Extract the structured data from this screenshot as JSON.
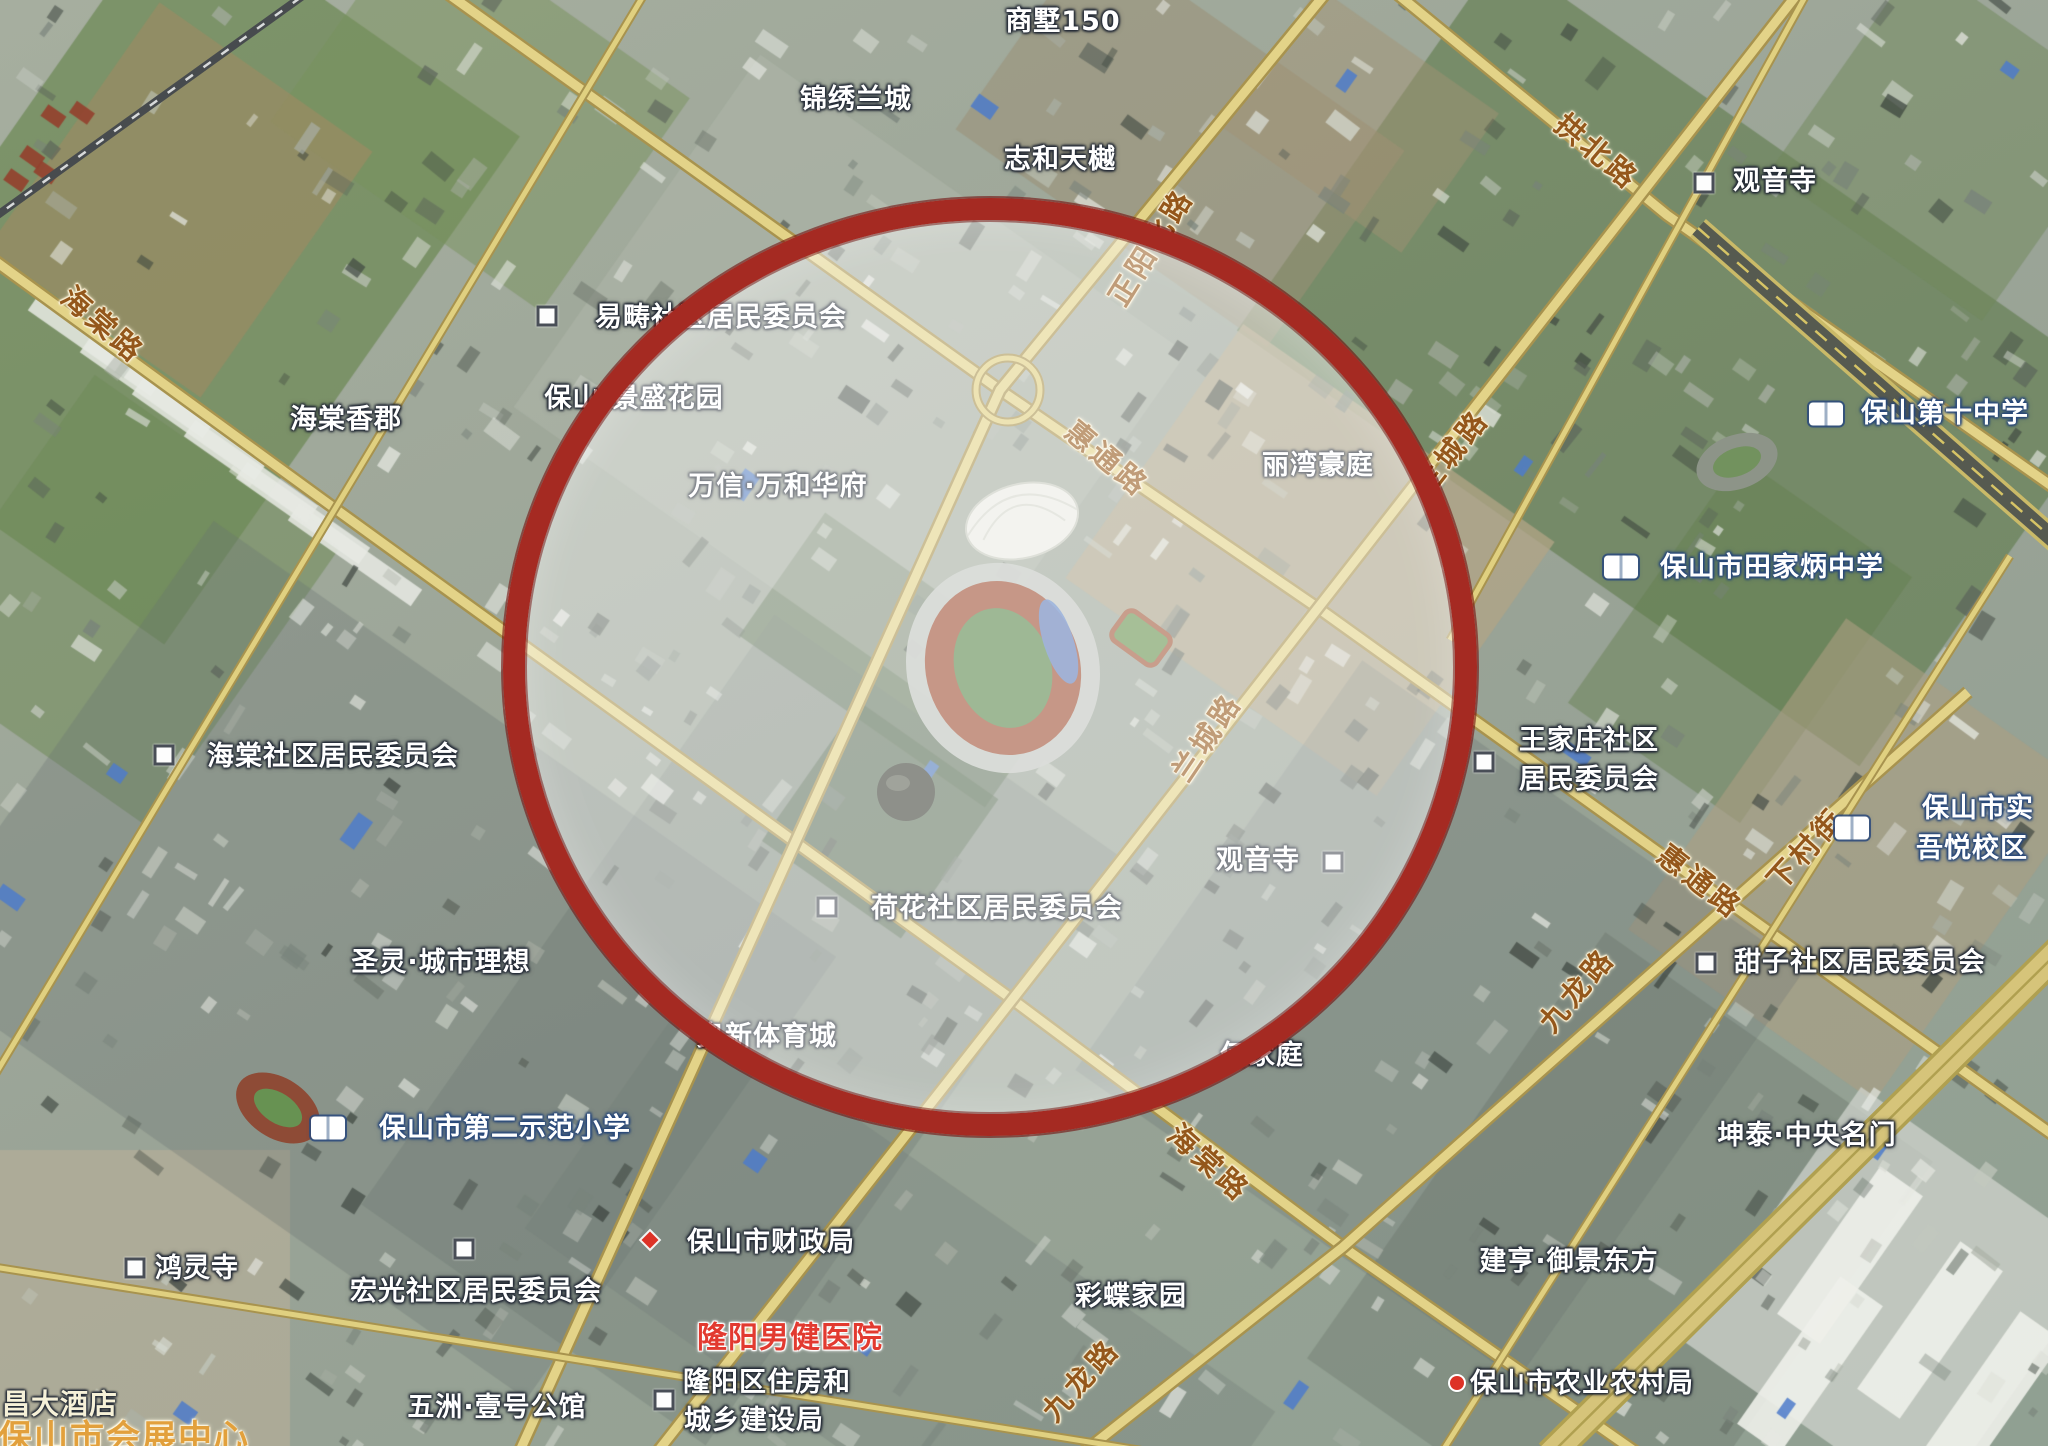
{
  "app": {
    "title": "satellite-map-view",
    "city_hint": "保山"
  },
  "colors": {
    "poi_label": "#ffffff",
    "road_label": "#94571b",
    "road_label_outline": "#f8efd4",
    "school_outline": "#2c4a7c",
    "hospital_red": "#e23a30",
    "landmark_gold": "#e2a03c",
    "road_fill": "#e3d388",
    "road_casing": "#a8934e",
    "highlight_ring": "#a52a22"
  },
  "highlight": {
    "cx": 990,
    "cy": 667,
    "rx": 465,
    "ry": 447,
    "border": 22,
    "fill_alpha": 0.41
  },
  "labels": [
    {
      "id": "shangshu150",
      "text": "商墅150",
      "x": 1063,
      "y": 22,
      "t": "poi"
    },
    {
      "id": "jinxiulancheng",
      "text": "锦绣兰城",
      "x": 856,
      "y": 100,
      "t": "poi"
    },
    {
      "id": "zhihetianyue",
      "text": "志和天樾",
      "x": 1060,
      "y": 160,
      "t": "poi"
    },
    {
      "id": "zhengyangbeilu",
      "text": "正阳北路",
      "x": 1151,
      "y": 247,
      "t": "road",
      "rot": -58
    },
    {
      "id": "gongbeilu",
      "text": "拱北路",
      "x": 1597,
      "y": 152,
      "t": "road",
      "rot": 40
    },
    {
      "id": "guanyinsi-n",
      "text": "观音寺",
      "x": 1775,
      "y": 182,
      "t": "poi"
    },
    {
      "id": "haitanglu-nw",
      "text": "海棠路",
      "x": 103,
      "y": 325,
      "t": "road",
      "rot": 41
    },
    {
      "id": "yichou",
      "text": "易畴社区居民委员会",
      "x": 721,
      "y": 318,
      "t": "poi"
    },
    {
      "id": "jingshenghuayuan",
      "text": "保山·景盛花园",
      "x": 634,
      "y": 399,
      "t": "poi"
    },
    {
      "id": "haitangxiangjun",
      "text": "海棠香郡",
      "x": 346,
      "y": 420,
      "t": "poi"
    },
    {
      "id": "wanxinwanhehuafu",
      "text": "万信·万和华府",
      "x": 778,
      "y": 487,
      "t": "poi"
    },
    {
      "id": "huitonglu-c",
      "text": "惠通路",
      "x": 1107,
      "y": 459,
      "t": "road",
      "rot": 40
    },
    {
      "id": "liwanhaoting",
      "text": "丽湾豪庭",
      "x": 1318,
      "y": 466,
      "t": "poi"
    },
    {
      "id": "lanchenglu-n",
      "text": "兰城路",
      "x": 1452,
      "y": 452,
      "t": "road",
      "rot": -52
    },
    {
      "id": "baoshandishizhongxue",
      "text": "保山第十中学",
      "x": 1945,
      "y": 414,
      "t": "school"
    },
    {
      "id": "tianjiabing",
      "text": "保山市田家炳中学",
      "x": 1772,
      "y": 568,
      "t": "school"
    },
    {
      "id": "haitangshequ",
      "text": "海棠社区居民委员会",
      "x": 333,
      "y": 757,
      "t": "poi"
    },
    {
      "id": "lanchenglu-c",
      "text": "兰城路",
      "x": 1207,
      "y": 737,
      "t": "road",
      "rot": -56
    },
    {
      "id": "wangjiazhuang-1",
      "text": "王家庄社区",
      "x": 1589,
      "y": 741,
      "t": "poi"
    },
    {
      "id": "wangjiazhuang-2",
      "text": "居民委员会",
      "x": 1589,
      "y": 780,
      "t": "poi"
    },
    {
      "id": "huitonglu-e",
      "text": "惠通路",
      "x": 1700,
      "y": 882,
      "t": "road",
      "rot": 38
    },
    {
      "id": "xiacunjie",
      "text": "下村街",
      "x": 1806,
      "y": 849,
      "t": "road",
      "rot": -48
    },
    {
      "id": "baoshanshishi",
      "text": "保山市实",
      "x": 1978,
      "y": 809,
      "t": "school"
    },
    {
      "id": "wuyuexiaoqu",
      "text": "吾悦校区",
      "x": 1972,
      "y": 849,
      "t": "school"
    },
    {
      "id": "guanyinsi-c",
      "text": "观音寺",
      "x": 1258,
      "y": 861,
      "t": "poi"
    },
    {
      "id": "hehuashequ",
      "text": "荷花社区居民委员会",
      "x": 997,
      "y": 909,
      "t": "poi"
    },
    {
      "id": "tianzishequ",
      "text": "甜子社区居民委员会",
      "x": 1860,
      "y": 963,
      "t": "poi"
    },
    {
      "id": "jiulonglu-e",
      "text": "九龙路",
      "x": 1577,
      "y": 990,
      "t": "road",
      "rot": -50
    },
    {
      "id": "shengling",
      "text": "圣灵·城市理想",
      "x": 441,
      "y": 963,
      "t": "poi"
    },
    {
      "id": "aoxintiyucheng",
      "text": "奥新体育城",
      "x": 767,
      "y": 1037,
      "t": "poi"
    },
    {
      "id": "hejiating",
      "text": "何家庭",
      "x": 1262,
      "y": 1056,
      "t": "poi"
    },
    {
      "id": "diershifanxiaoxue",
      "text": "保山市第二示范小学",
      "x": 505,
      "y": 1129,
      "t": "school"
    },
    {
      "id": "haitanglu-s",
      "text": "海棠路",
      "x": 1209,
      "y": 1163,
      "t": "road",
      "rot": 42
    },
    {
      "id": "kuntai",
      "text": "坤泰·中央名门",
      "x": 1807,
      "y": 1136,
      "t": "poi"
    },
    {
      "id": "honglingsi",
      "text": "鸿灵寺",
      "x": 197,
      "y": 1269,
      "t": "poi"
    },
    {
      "id": "hongguangshequ",
      "text": "宏光社区居民委员会",
      "x": 476,
      "y": 1292,
      "t": "poi"
    },
    {
      "id": "caizhengju",
      "text": "保山市财政局",
      "x": 771,
      "y": 1243,
      "t": "poi"
    },
    {
      "id": "longyangnanjian",
      "text": "隆阳男健医院",
      "x": 790,
      "y": 1338,
      "t": "red"
    },
    {
      "id": "caidiejiayuan",
      "text": "彩蝶家园",
      "x": 1131,
      "y": 1297,
      "t": "poi"
    },
    {
      "id": "jianheng",
      "text": "建亨·御景东方",
      "x": 1569,
      "y": 1262,
      "t": "poi"
    },
    {
      "id": "jiulonglu-s",
      "text": "九龙路",
      "x": 1081,
      "y": 1380,
      "t": "road",
      "rot": -48
    },
    {
      "id": "nongyenongcunju",
      "text": "保山市农业农村局",
      "x": 1582,
      "y": 1384,
      "t": "poi"
    },
    {
      "id": "changdajiudian",
      "text": "昌大酒店",
      "x": 60,
      "y": 1404,
      "t": "hotel"
    },
    {
      "id": "huizhanzhongxin",
      "text": "保山市会展中心",
      "x": 124,
      "y": 1438,
      "t": "gold"
    },
    {
      "id": "wuzhouyihao",
      "text": "五洲·壹号公馆",
      "x": 497,
      "y": 1408,
      "t": "poi"
    },
    {
      "id": "zhufangju-1",
      "text": "隆阳区住房和",
      "x": 767,
      "y": 1383,
      "t": "poi"
    },
    {
      "id": "zhufangju-2",
      "text": "城乡建设局",
      "x": 754,
      "y": 1421,
      "t": "poi"
    }
  ],
  "icons": [
    {
      "id": "guanyinsi-n-marker",
      "kind": "sq",
      "x": 1704,
      "y": 183
    },
    {
      "id": "yichou-marker",
      "kind": "sq",
      "x": 547,
      "y": 316
    },
    {
      "id": "haitangshequ-marker",
      "kind": "sq",
      "x": 164,
      "y": 755
    },
    {
      "id": "wangjiazhuang-marker",
      "kind": "sq",
      "x": 1484,
      "y": 762
    },
    {
      "id": "guanyinsi-c-marker",
      "kind": "sq",
      "x": 1333,
      "y": 862
    },
    {
      "id": "hehuashequ-marker",
      "kind": "sq",
      "x": 827,
      "y": 907
    },
    {
      "id": "tianzishequ-marker",
      "kind": "sq",
      "x": 1706,
      "y": 963
    },
    {
      "id": "honglingsi-marker",
      "kind": "sq",
      "x": 135,
      "y": 1268
    },
    {
      "id": "hongguang-marker",
      "kind": "sq",
      "x": 464,
      "y": 1249
    },
    {
      "id": "zhufangju-marker",
      "kind": "sq",
      "x": 664,
      "y": 1400
    },
    {
      "id": "shizhongxue-book",
      "kind": "book",
      "x": 1826,
      "y": 414
    },
    {
      "id": "tianjiabing-book",
      "kind": "book",
      "x": 1621,
      "y": 567
    },
    {
      "id": "wuyue-book",
      "kind": "book",
      "x": 1852,
      "y": 828
    },
    {
      "id": "diershifan-book",
      "kind": "book",
      "x": 328,
      "y": 1128
    },
    {
      "id": "caizhengju-marker",
      "kind": "diamond",
      "x": 650,
      "y": 1240
    },
    {
      "id": "nongye-marker",
      "kind": "dotred",
      "x": 1457,
      "y": 1383
    }
  ],
  "roads": [
    {
      "name": "海棠路",
      "class": "major",
      "d": "M -20,250 L 330,505 L 1013,1000 L 1343,1247 L 1640,1455"
    },
    {
      "name": "惠通路",
      "class": "major",
      "d": "M 440,-12 L 1000,390 L 1318,608 L 1700,882 L 2060,1140"
    },
    {
      "name": "拱北路",
      "class": "major",
      "d": "M 1390,-12 L 1667,215 L 2060,492"
    },
    {
      "name": "正阳北路",
      "class": "major",
      "d": "M 1330,-12 L 1000,390 L 518,1455"
    },
    {
      "name": "兰城路",
      "class": "major",
      "d": "M 1802,-12 L 1318,608 L 1008,1005 L 655,1455"
    },
    {
      "name": "九龙路",
      "class": "major",
      "d": "M 1968,692 L 1343,1247 L 1080,1455"
    },
    {
      "name": "下村街",
      "class": "minor",
      "d": "M 2010,556 L 1440,1455"
    },
    {
      "name": "",
      "class": "minor",
      "d": "M 648,-12 L 160,800 L -20,1100"
    },
    {
      "name": "",
      "class": "minor",
      "d": "M -12,1266 L 560,1357 L 1170,1455"
    },
    {
      "name": "",
      "class": "minor",
      "d": "M 1810,-12 L 1450,640"
    },
    {
      "name": "roundabout",
      "class": "minor",
      "d": "M 1040,390 a 32,32 0 1 0 -64,0 a 32,32 0 1 0 64,0"
    },
    {
      "name": "railway",
      "class": "rail",
      "d": "M 318,-15 L -40,242"
    },
    {
      "name": "",
      "class": "dark",
      "d": "M 1698,228 L 2060,545"
    },
    {
      "name": "expressway",
      "class": "wide",
      "d": "M 2060,950 L 1550,1455"
    }
  ]
}
